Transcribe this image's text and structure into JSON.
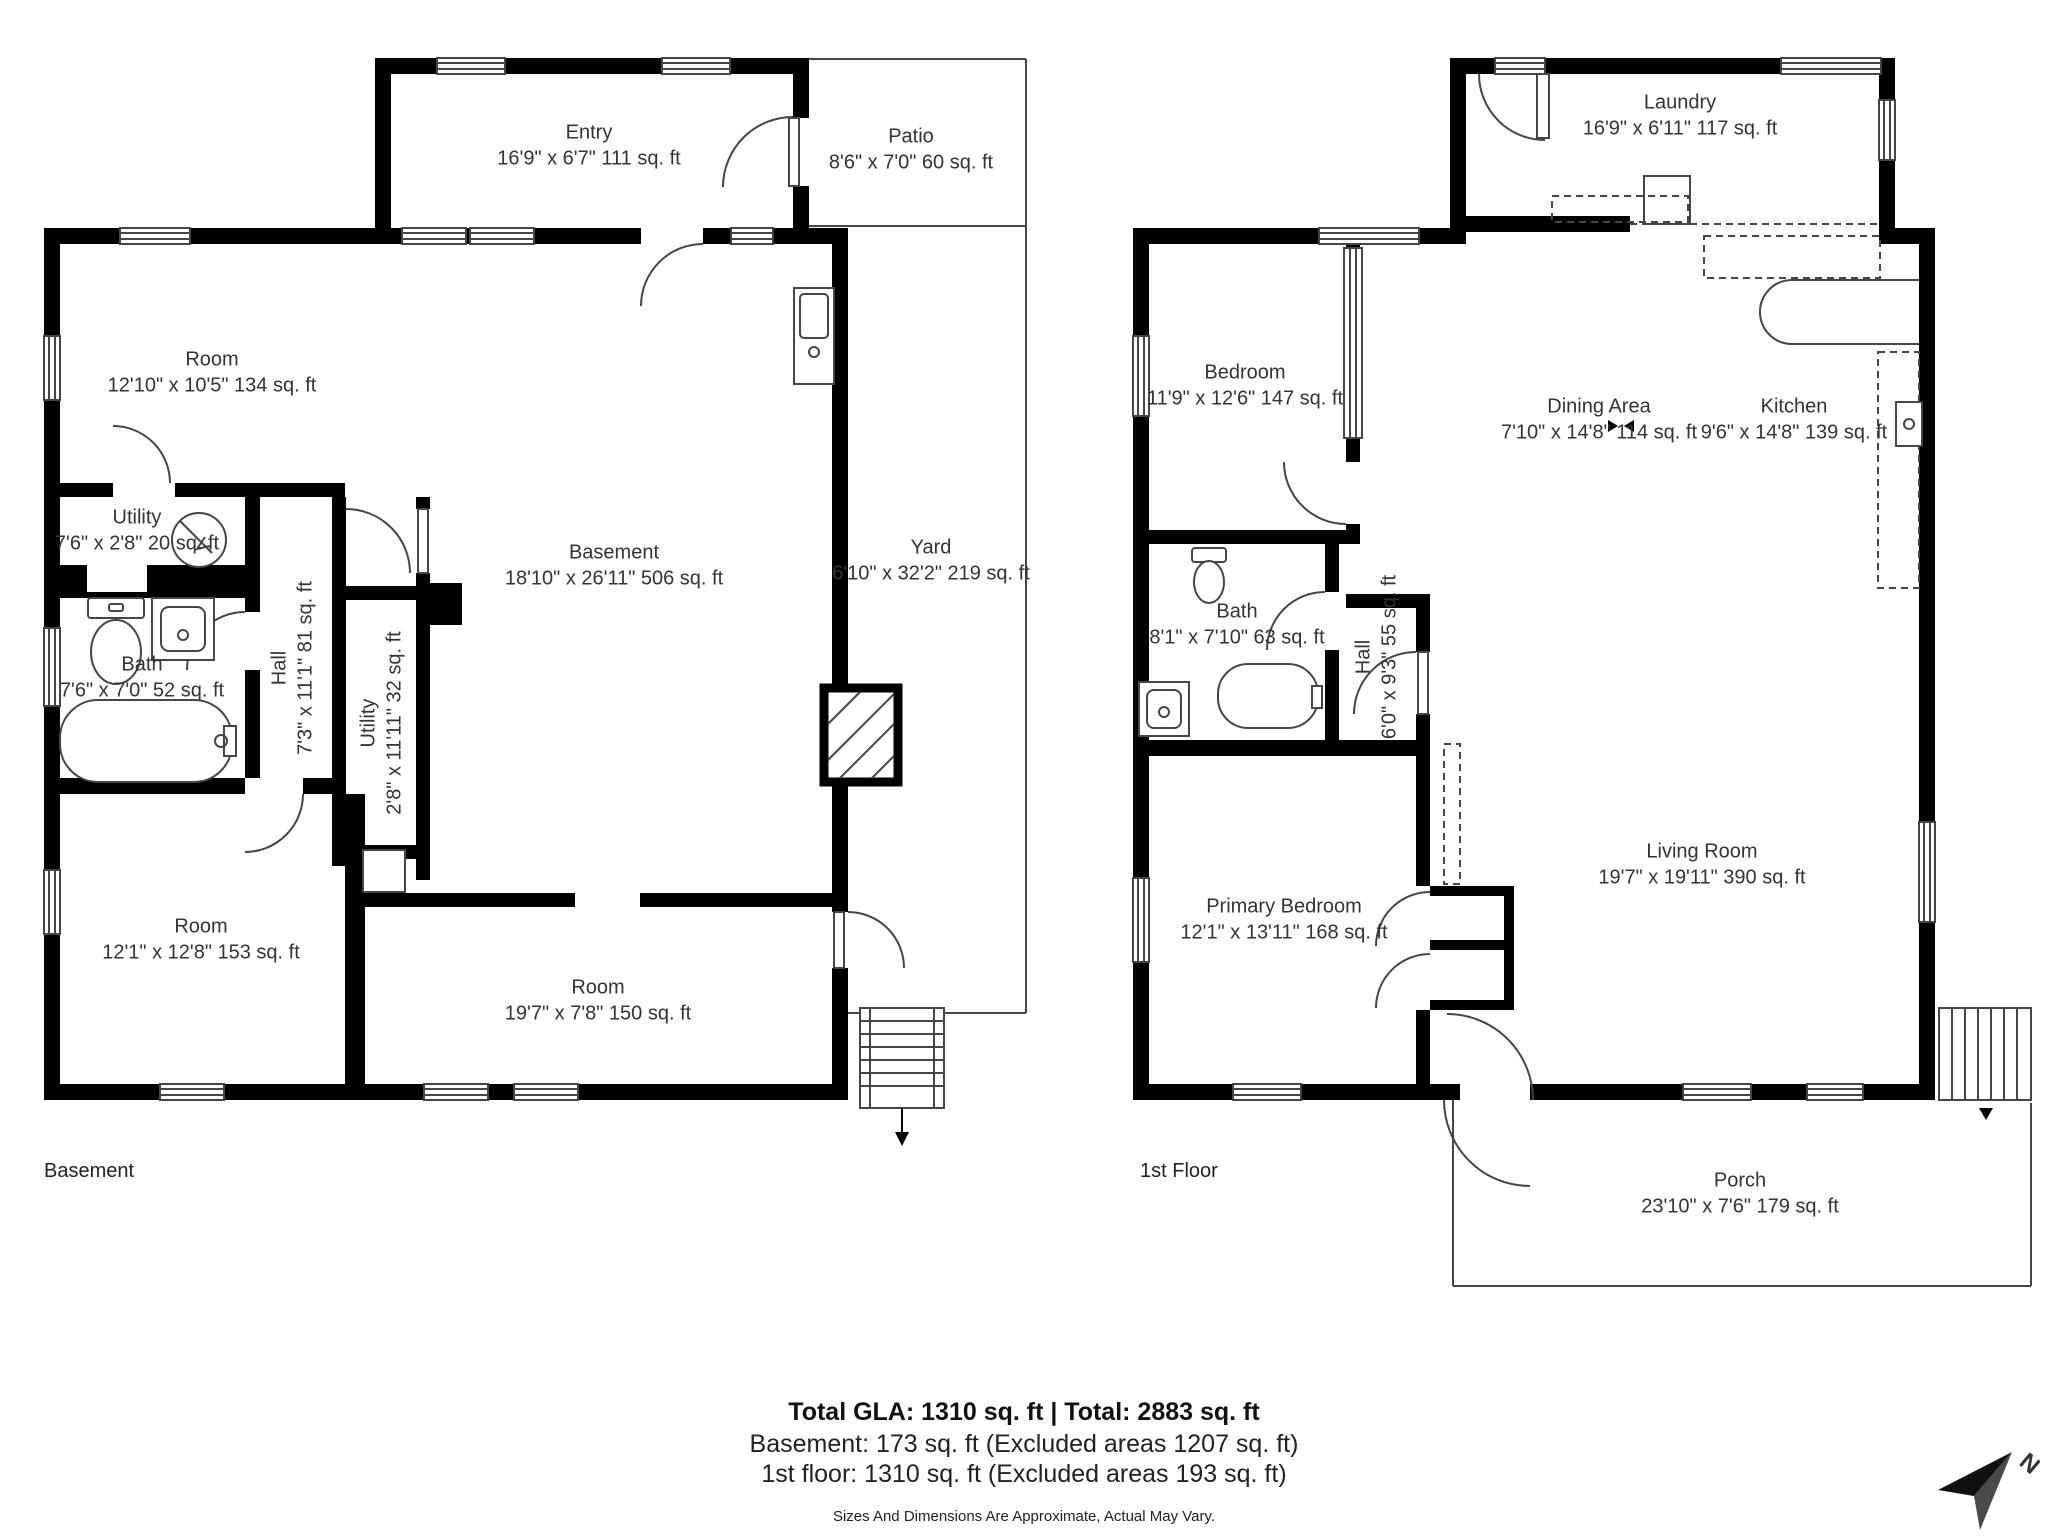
{
  "page": {
    "background": "#ffffff",
    "wall_color": "#000000",
    "line_color": "#454545",
    "text_color": "#333333"
  },
  "basement": {
    "floor_label": "Basement",
    "rooms": {
      "entry": {
        "name": "Entry",
        "dims": "16'9\" x 6'7\" 111 sq. ft"
      },
      "patio": {
        "name": "Patio",
        "dims": "8'6\" x 7'0\" 60 sq. ft"
      },
      "room_top_left": {
        "name": "Room",
        "dims": "12'10\" x 10'5\" 134 sq. ft"
      },
      "utility_small": {
        "name": "Utility",
        "dims": "7'6\" x 2'8\" 20 sq. ft"
      },
      "bath": {
        "name": "Bath",
        "dims": "7'6\" x 7'0\" 52 sq. ft"
      },
      "hall": {
        "name": "Hall",
        "dims": "7'3\" x 11'1\" 81 sq. ft"
      },
      "utility_tall": {
        "name": "Utility",
        "dims": "2'8\" x 11'11\" 32 sq. ft"
      },
      "basement_room": {
        "name": "Basement",
        "dims": "18'10\" x 26'11\" 506 sq. ft"
      },
      "yard": {
        "name": "Yard",
        "dims": "6'10\" x 32'2\" 219 sq. ft"
      },
      "room_bottom_left": {
        "name": "Room",
        "dims": "12'1\" x 12'8\" 153 sq. ft"
      },
      "room_bottom_center": {
        "name": "Room",
        "dims": "19'7\" x 7'8\" 150 sq. ft"
      }
    }
  },
  "first_floor": {
    "floor_label": "1st Floor",
    "rooms": {
      "laundry": {
        "name": "Laundry",
        "dims": "16'9\" x 6'11\" 117 sq. ft"
      },
      "bedroom": {
        "name": "Bedroom",
        "dims": "11'9\" x 12'6\" 147 sq. ft"
      },
      "dining_area": {
        "name": "Dining Area",
        "dims": "7'10\" x 14'8\" 114 sq. ft"
      },
      "kitchen": {
        "name": "Kitchen",
        "dims": "9'6\" x 14'8\" 139 sq. ft"
      },
      "bath": {
        "name": "Bath",
        "dims": "8'1\" x 7'10\" 63 sq. ft"
      },
      "hall": {
        "name": "Hall",
        "dims": "6'0\" x 9'3\" 55 sq. ft"
      },
      "primary_bedroom": {
        "name": "Primary Bedroom",
        "dims": "12'1\" x 13'11\" 168 sq. ft"
      },
      "living_room": {
        "name": "Living Room",
        "dims": "19'7\" x 19'11\" 390 sq. ft"
      },
      "porch": {
        "name": "Porch",
        "dims": "23'10\" x 7'6\" 179 sq. ft"
      }
    }
  },
  "summary": {
    "total_line": "Total GLA: 1310 sq. ft | Total: 2883 sq. ft",
    "basement_line": "Basement: 173 sq. ft (Excluded areas 1207 sq. ft)",
    "first_floor_line": "1st floor: 1310 sq. ft (Excluded areas 193 sq. ft)",
    "disclaimer": "Sizes And Dimensions Are Approximate, Actual May Vary."
  },
  "compass": {
    "label": "N"
  }
}
